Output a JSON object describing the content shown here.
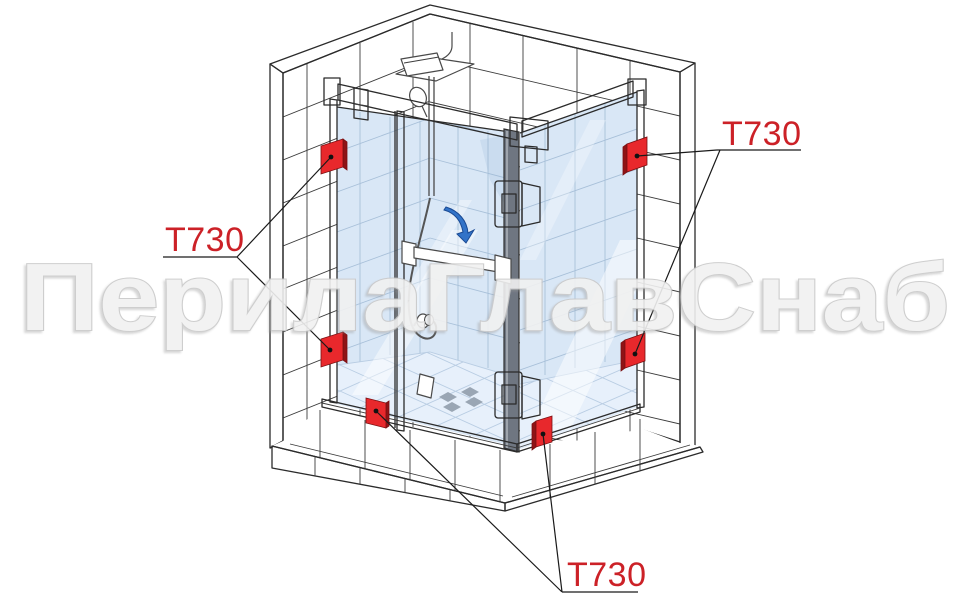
{
  "page": {
    "width": 970,
    "height": 606,
    "background": "#ffffff"
  },
  "watermark": {
    "text": "ПерилаГлавСнаб"
  },
  "callouts": {
    "part_code": "Т730",
    "marker_count": 6,
    "labels": [
      {
        "position": "left",
        "text": "Т730",
        "points_to": [
          "wall-bracket-upper-left",
          "wall-bracket-lower-left"
        ]
      },
      {
        "position": "top-right",
        "text": "Т730",
        "points_to": [
          "wall-bracket-upper-right",
          "wall-bracket-lower-right"
        ]
      },
      {
        "position": "bottom",
        "text": "Т730",
        "points_to": [
          "floor-bracket-front",
          "floor-bracket-right"
        ]
      }
    ]
  },
  "colors": {
    "marker_red": "#e8282c",
    "marker_red_dark": "#8f1316",
    "label_red": "#cc2127",
    "line": "#2b2b2b",
    "glass": "#d9e7f6",
    "glass_grout": "#a8c0d9",
    "floor": "#e7f0fb",
    "floor_grout": "#b9cde3",
    "watermark": "#f1f1f1"
  },
  "diagram": {
    "type": "isometric-technical-illustration",
    "subject": "Corner glass shower enclosure with hinged door installed in a tiled niche",
    "highlighted_part": "Т730 glass mounting bracket (shown as red squares)",
    "components": [
      "left tiled wall",
      "right tiled wall",
      "tiled step",
      "front fixed glass panel",
      "hinged glass door",
      "side return glass panel",
      "top stabilizer bar",
      "glass-to-glass hinges",
      "door knob",
      "towel-bar handle",
      "rain shower head with shelf",
      "hand shower",
      "shower hose",
      "door swing arrow",
      "tiled shower floor with mosaic motif"
    ]
  }
}
